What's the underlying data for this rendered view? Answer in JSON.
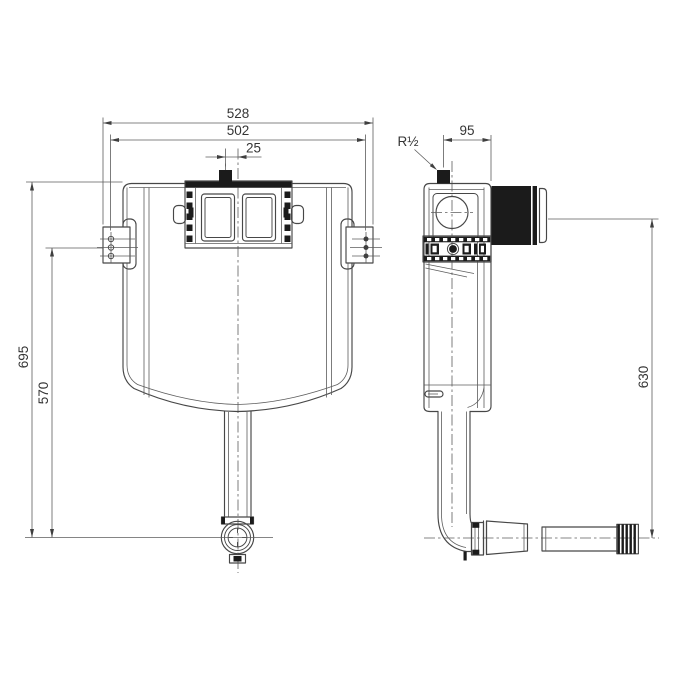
{
  "page": {
    "background": "#ffffff"
  },
  "drawing": {
    "type": "technical-drawing",
    "subject": "concealed-cistern-front-and-side-views",
    "line_color": "#474747",
    "dark_fill": "#1b1b1b",
    "dimensions": {
      "overall_width": "528",
      "fixing_centres": "502",
      "inlet_offset": "25",
      "inlet_setback": "95",
      "inlet_thread": "R½",
      "overall_height": "695",
      "bracket_height": "570",
      "outlet_drop": "630"
    }
  }
}
